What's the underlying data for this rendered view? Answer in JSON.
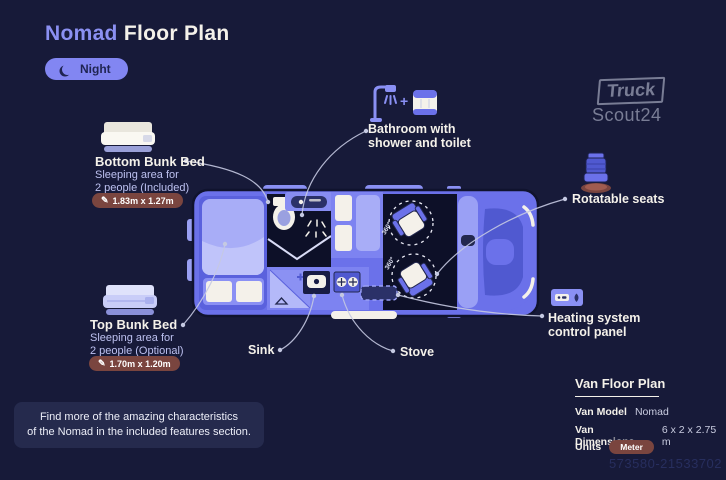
{
  "colors": {
    "background": "#171A39",
    "accent_periwinkle": "#8286F2",
    "van_blue": "#6B71EA",
    "van_light": "#A8ADF7",
    "dark_interior": "#0D1028",
    "badge_maroon": "#7A453F",
    "text_primary": "#F4F1EA",
    "text_secondary": "#BDC1F0"
  },
  "header": {
    "title_accent": "Nomad",
    "title_rest": "Floor Plan",
    "night_toggle": "Night"
  },
  "brand": {
    "line1": "Truck",
    "line2": "Scout24"
  },
  "callouts": {
    "bottom_bunk": {
      "title": "Bottom Bunk Bed",
      "desc1": "Sleeping area for",
      "desc2": "2 people (Included)",
      "dimensions": "1.83m x 1.27m"
    },
    "top_bunk": {
      "title": "Top Bunk Bed",
      "desc1": "Sleeping area for",
      "desc2": "2 people (Optional)",
      "dimensions": "1.70m x 1.20m"
    },
    "bathroom": {
      "plus": "+",
      "line1": "Bathroom with",
      "line2": "shower and toilet"
    },
    "rotatable_seats": {
      "label": "Rotatable seats"
    },
    "heating": {
      "line1": "Heating system",
      "line2": "control panel"
    },
    "sink": {
      "label": "Sink"
    },
    "stove": {
      "label": "Stove"
    }
  },
  "floorplan": {
    "seat_rotation_front": "360°",
    "seat_rotation_rear": "360°"
  },
  "note": {
    "line1": "Find more of the amazing characteristics",
    "line2": "of the Nomad in the included features section."
  },
  "spec_panel": {
    "title": "Van Floor Plan",
    "model_label": "Van Model",
    "model_value": "Nomad",
    "dimensions_label": "Van Dimensions",
    "dimensions_value": "6 x 2 x 2.75 m",
    "units_label": "Units",
    "units_value": "Meter"
  },
  "watermark": "573580-21533702"
}
